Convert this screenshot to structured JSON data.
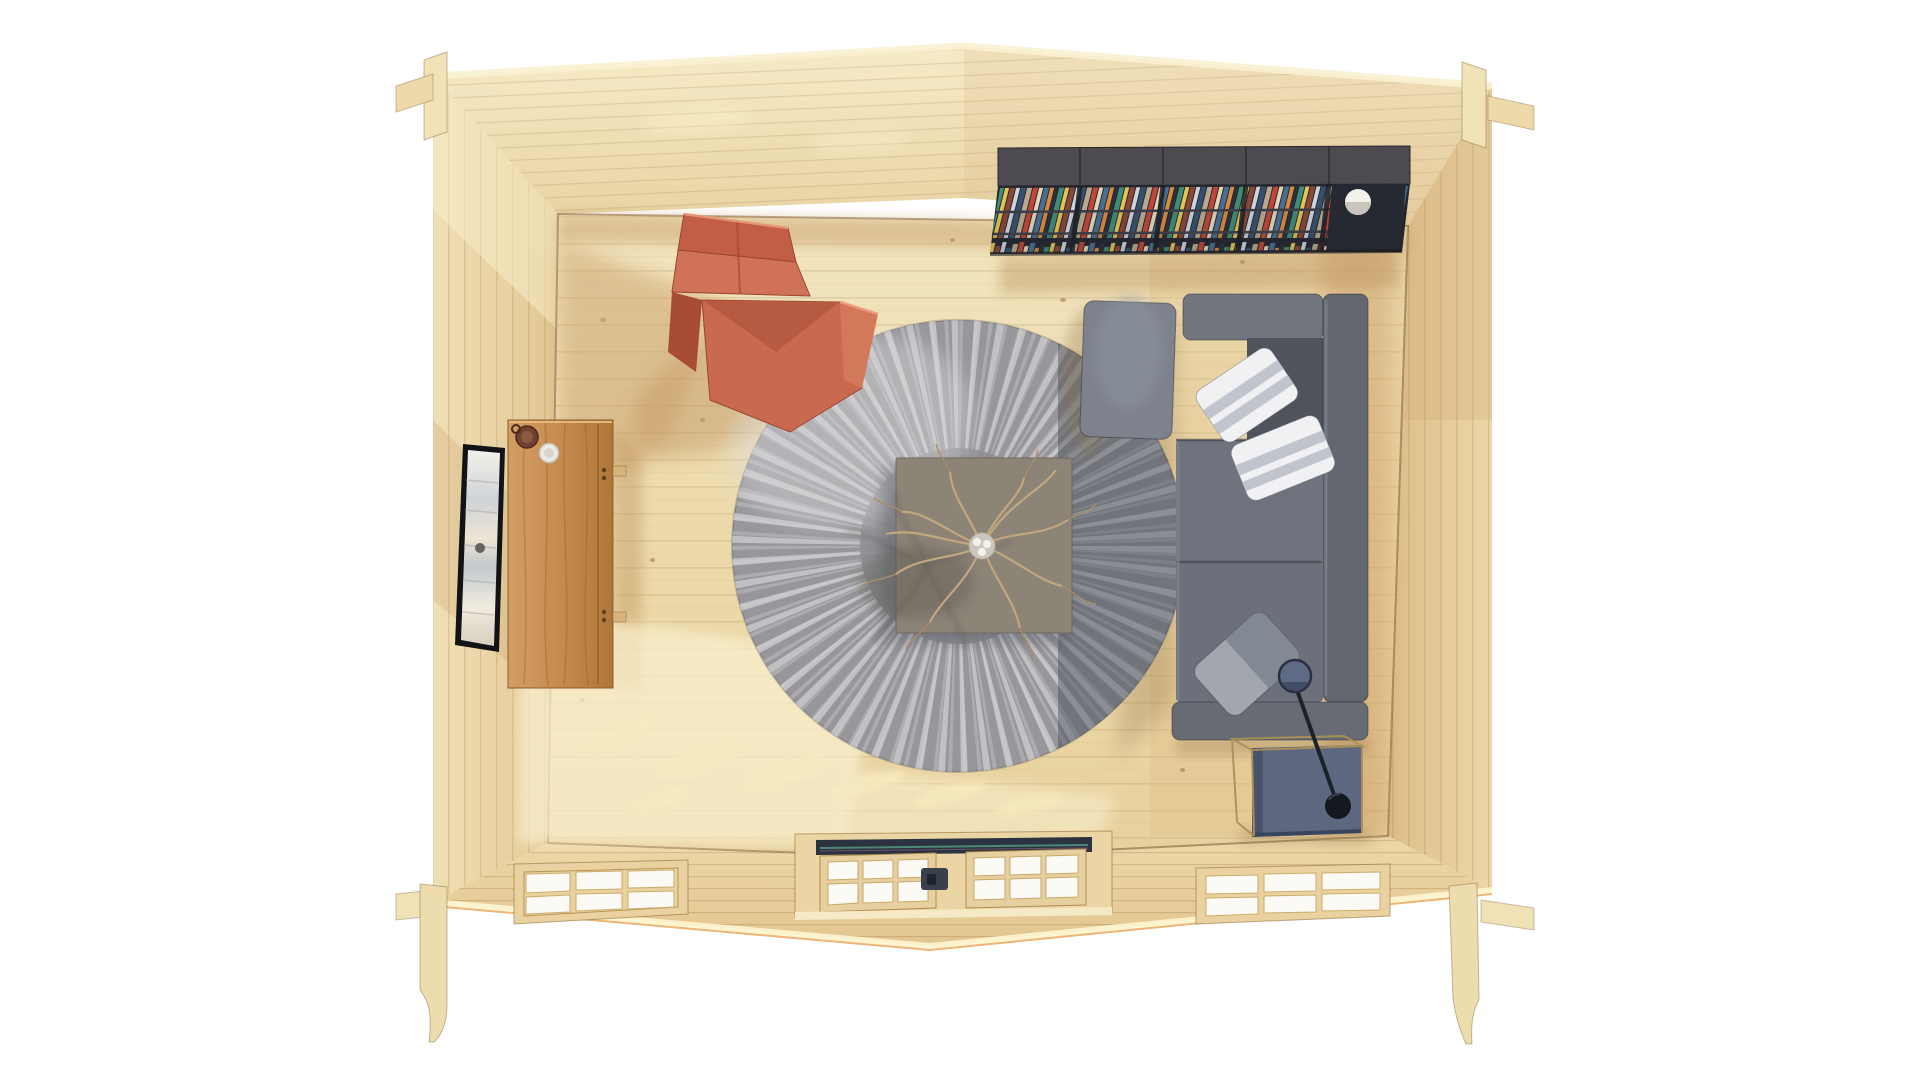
{
  "scene": {
    "view": "top-down bird's-eye view",
    "subject": "3D render of a log cabin living room interior, roof removed",
    "background": "#ffffff"
  },
  "colors": {
    "background": "#ffffff",
    "floor": "#ecd9a9",
    "floorLight": "#f3e7c3",
    "sunPatch": "#f9efcd",
    "shadowTan": "#c49a67",
    "wallTop": "#f3e7c2",
    "wallLeft": "#ead7a9",
    "wallRight": "#e4c794",
    "wallBottom": "#ead4a3",
    "pineEdge": "#fbf2d3",
    "trim": "#f0e1b6",
    "bookshelfTop": "#4d4a4f",
    "bookshelfBody": "#23262e",
    "shelfLamp": "#f3f1ec",
    "sofa": "#6e737d",
    "sofaDark": "#4e535c",
    "sofaArm": "#666b74",
    "sofaBack": "#61666f",
    "chaise": "#7d828c",
    "pillowWhite": "#f1f1f4",
    "pillowStripe": "#b6bcc6",
    "pillowGray": "#a2a7af",
    "rug": "#97969a",
    "rugStreak": "#ececee",
    "rugShadow": "#3e4451",
    "coffeeTable": "#8d8478",
    "twig": "#c2a77c",
    "chair": "#c96a50",
    "chairDark": "#ad4f38",
    "chairLight": "#d98a6d",
    "oak": "#c78e51",
    "oakDark": "#9c6527",
    "tvFrame": "#121317",
    "tvScreen": "#efeae0",
    "sideTable": "#5d6880",
    "sideTableDark": "#39455e",
    "brass": "#ab9055",
    "lampShade": "#5f6b86",
    "lampDark": "#15181e",
    "glass": "#fbfaf4",
    "track": "#2b3240",
    "trackTeal": "#4d8876",
    "handle": "#39404c",
    "mug": "#6e4130",
    "cup": "#eceae6"
  },
  "objects": {
    "cabin": {
      "label": "Pine log cabin shell seen from above (roof removed)"
    },
    "floor": {
      "label": "Pine plank floor with sunlight patches"
    },
    "bookshelf": {
      "label": "Dark wall shelf unit filled with books",
      "lamp": "White sphere lamp on shelf"
    },
    "sofa": {
      "label": "Gray sectional sofa with chaise"
    },
    "pillows": {
      "p1": "White striped cushion",
      "p2": "White striped cushion",
      "p3": "Gray cushion"
    },
    "rug": {
      "label": "Round gray shag rug"
    },
    "coffeeTable": {
      "label": "Square gray coffee table",
      "decor": "Dried twig branch in glass vase"
    },
    "armchair": {
      "label": "Terracotta leather lounge chair"
    },
    "sideboard": {
      "label": "Oak media sideboard",
      "item1": "Brown mug",
      "item2": "White cup"
    },
    "tv": {
      "label": "Flat-screen TV on left wall"
    },
    "sideTable": {
      "label": "Steel-blue cube side table with brass frame"
    },
    "arcLamp": {
      "label": "Dark arc floor lamp"
    },
    "door": {
      "label": "Double glazed door, six panes per leaf"
    },
    "windowLeft": {
      "label": "Six-pane window"
    },
    "windowRight": {
      "label": "Six-pane window"
    }
  }
}
